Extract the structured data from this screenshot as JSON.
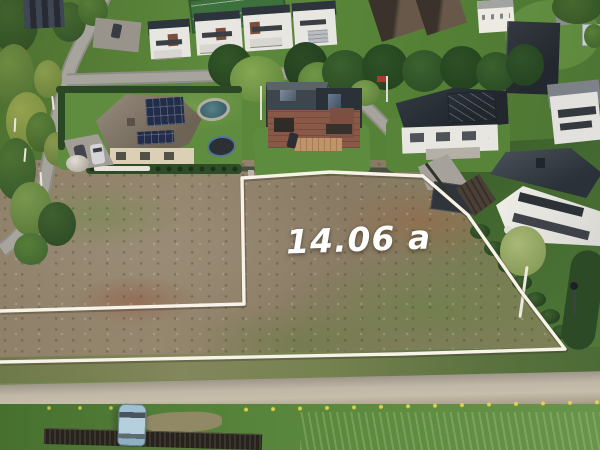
{
  "photo": {
    "kind": "aerial-drone-photo",
    "subject": "Vacant residential land plot outlined in white in a suburban neighborhood with houses, streets and forest",
    "area_label": "14.06 a"
  },
  "boundary": {
    "stroke_color": "#f7f3e8",
    "stroke_width": 3.4,
    "points": [
      [
        0,
        311
      ],
      [
        244,
        304
      ],
      [
        242,
        178
      ],
      [
        330,
        172
      ],
      [
        423,
        176
      ],
      [
        468,
        215
      ],
      [
        520,
        290
      ],
      [
        565,
        349
      ],
      [
        400,
        354
      ],
      [
        200,
        358
      ],
      [
        0,
        362
      ]
    ]
  },
  "colors": {
    "label_text": "#ffffff",
    "dirt_field": "#8d7d69",
    "lawn_green": "#5d8a3c",
    "forest_green": "#41632e",
    "asphalt_road": "#a7a49e",
    "gravel_road": "#c0b7a6",
    "dark_roof": "#2e343b",
    "brick_wall": "#8a5847",
    "solar_panel": "#222d4a",
    "hedge_green": "#2c4a26",
    "dark_fence": "#27221b",
    "parked_car_blue": "#9fc0d2",
    "red_flag": "#b23530",
    "tennis_court": "#3c703c",
    "pool_water": "#446d77"
  },
  "scene_elements": [
    "birch-forest",
    "residential-street",
    "street-junction",
    "townhouse-row",
    "tennis-court",
    "hip-roof-house-with-solar-panels",
    "swimming-pool",
    "trampoline",
    "dome-greenhouse",
    "driveway-with-parked-cars",
    "brick-house",
    "flagpole-with-red-flag",
    "white-house-with-glass-roof",
    "modern-white-house",
    "wooden-garage",
    "pine-tree-row",
    "thuja-hedge",
    "birch-tree",
    "street-lamp",
    "vacant-dirt-plot",
    "plot-boundary-outline",
    "area-label",
    "gravel-road",
    "dandelion-verge",
    "corrugated-fence",
    "blue-car"
  ]
}
